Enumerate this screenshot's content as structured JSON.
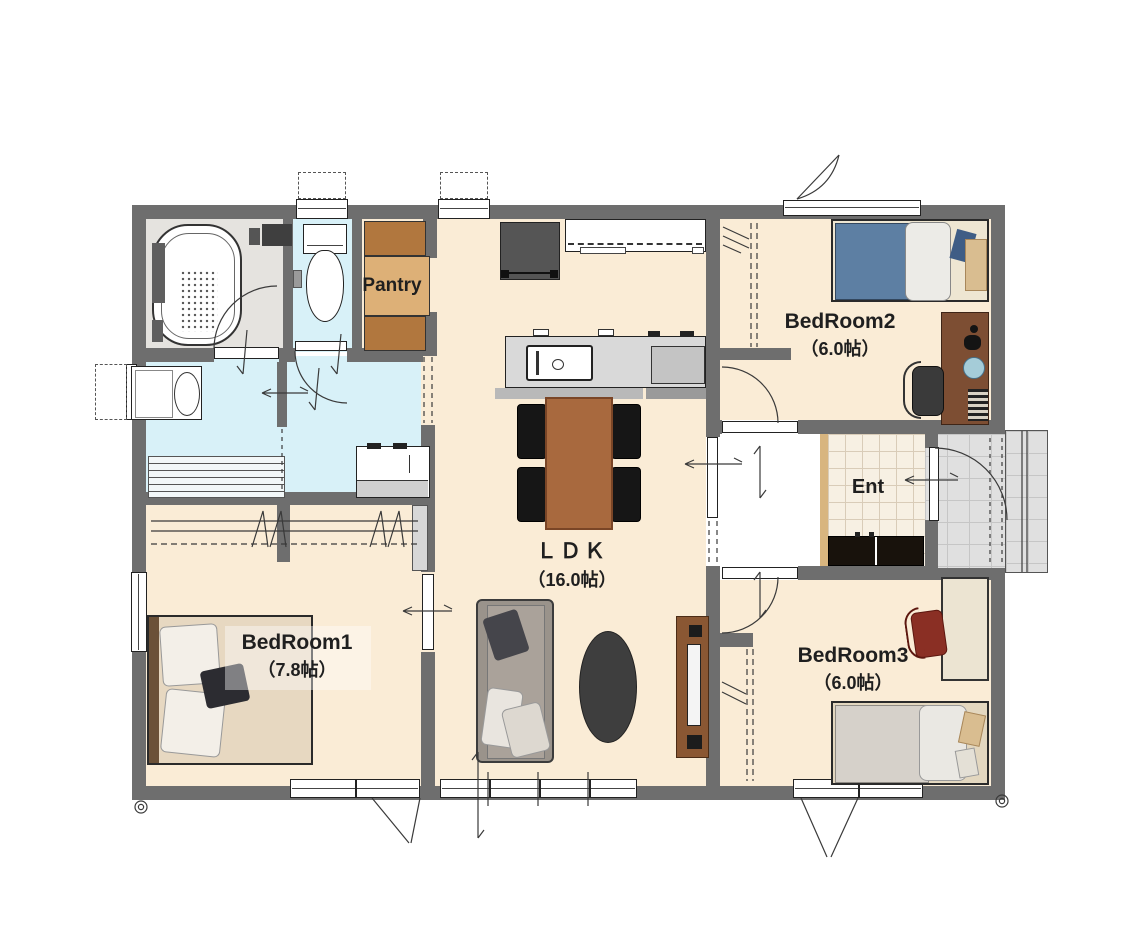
{
  "plan": {
    "pantry": "Pantry",
    "ent": "Ent",
    "ldk_name": "ＬＤＫ",
    "ldk_size": "（16.0帖）",
    "bedroom1_name": "BedRoom1",
    "bedroom1_size": "（7.8帖）",
    "bedroom2_name": "BedRoom2",
    "bedroom2_size": "（6.0帖）",
    "bedroom3_name": "BedRoom3",
    "bedroom3_size": "（6.0帖）"
  },
  "colors": {
    "wall": "#6e6e6e",
    "floor": "#faecd6",
    "water": "#d8f1f8",
    "bath": "#e5e3df",
    "tile": "#f7f0e3",
    "tileLine": "#d9ccb8",
    "porch": "#e0e0e0",
    "porchLine": "#c6c6c6",
    "woodDark": "#b1773e",
    "woodMid": "#ddb077",
    "table": "#a8693e",
    "tv": "#8a5733",
    "desk": "#7d4e33",
    "deskPale": "#ece4d2",
    "blanketBlue": "#5d7fa3",
    "blanketGray": "#d6d1ca",
    "bedTan": "#e7d8c1",
    "chairDark": "#161616",
    "chairRed": "#8a2f24",
    "rug": "#3e3e3e",
    "sofa": "#9a938b",
    "cabinet": "#18120c",
    "entEdge": "#d8b57f",
    "text": "#1f1f1f"
  }
}
